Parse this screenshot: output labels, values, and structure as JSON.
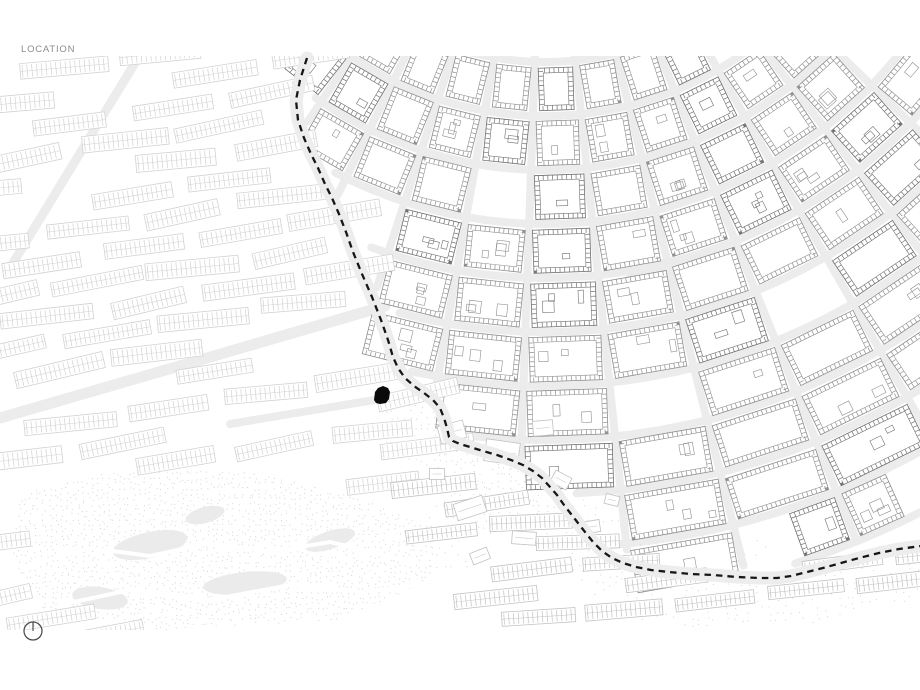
{
  "title": "LOCATION",
  "map": {
    "colors": {
      "background": "#ffffff",
      "street": "#ececec",
      "canal_building": "#8e8e8e",
      "canal_building_dark": "#707070",
      "west_building": "#d2d2d2",
      "south_building": "#c2c2c2",
      "stipple": "#d8d8d8",
      "pond": "#ebebeb",
      "route_band": "#ededed",
      "route_dash": "#161616",
      "site_marker": "#0a0a0a",
      "title_text": "#8c8c8c",
      "compass": "#4d4d4d"
    },
    "route_dash_points": [
      [
        307,
        58
      ],
      [
        300,
        80
      ],
      [
        296,
        100
      ],
      [
        298,
        120
      ],
      [
        304,
        138
      ],
      [
        311,
        154
      ],
      [
        318,
        168
      ],
      [
        325,
        184
      ],
      [
        332,
        198
      ],
      [
        339,
        214
      ],
      [
        346,
        232
      ],
      [
        353,
        252
      ],
      [
        362,
        274
      ],
      [
        372,
        297
      ],
      [
        381,
        320
      ],
      [
        388,
        340
      ],
      [
        393,
        357
      ],
      [
        398,
        368
      ],
      [
        405,
        378
      ],
      [
        414,
        386
      ],
      [
        424,
        393
      ],
      [
        433,
        400
      ],
      [
        440,
        408
      ],
      [
        444,
        418
      ],
      [
        447,
        428
      ],
      [
        449,
        437
      ],
      [
        453,
        441
      ],
      [
        460,
        444
      ],
      [
        470,
        447
      ],
      [
        483,
        451
      ],
      [
        497,
        455
      ],
      [
        511,
        460
      ],
      [
        523,
        465
      ],
      [
        533,
        471
      ],
      [
        542,
        478
      ],
      [
        550,
        487
      ],
      [
        557,
        495
      ],
      [
        564,
        505
      ],
      [
        571,
        514
      ],
      [
        578,
        523
      ],
      [
        585,
        532
      ],
      [
        593,
        542
      ],
      [
        602,
        551
      ],
      [
        612,
        558
      ],
      [
        623,
        563
      ],
      [
        636,
        567
      ],
      [
        651,
        570
      ],
      [
        669,
        572
      ],
      [
        691,
        574
      ],
      [
        713,
        575
      ],
      [
        737,
        577
      ],
      [
        759,
        578
      ],
      [
        777,
        578
      ],
      [
        791,
        576
      ],
      [
        807,
        572
      ],
      [
        823,
        568
      ],
      [
        841,
        563
      ],
      [
        859,
        558
      ],
      [
        879,
        553
      ],
      [
        899,
        549
      ],
      [
        921,
        546
      ]
    ],
    "site_marker_points": [
      [
        374,
        400
      ],
      [
        375,
        392
      ],
      [
        378,
        388
      ],
      [
        383,
        386
      ],
      [
        388,
        388
      ],
      [
        390,
        392
      ],
      [
        389,
        399
      ],
      [
        386,
        403
      ],
      [
        380,
        404
      ],
      [
        376,
        403
      ]
    ],
    "compass": {
      "cx": 33,
      "cy": 631,
      "r": 9
    }
  }
}
